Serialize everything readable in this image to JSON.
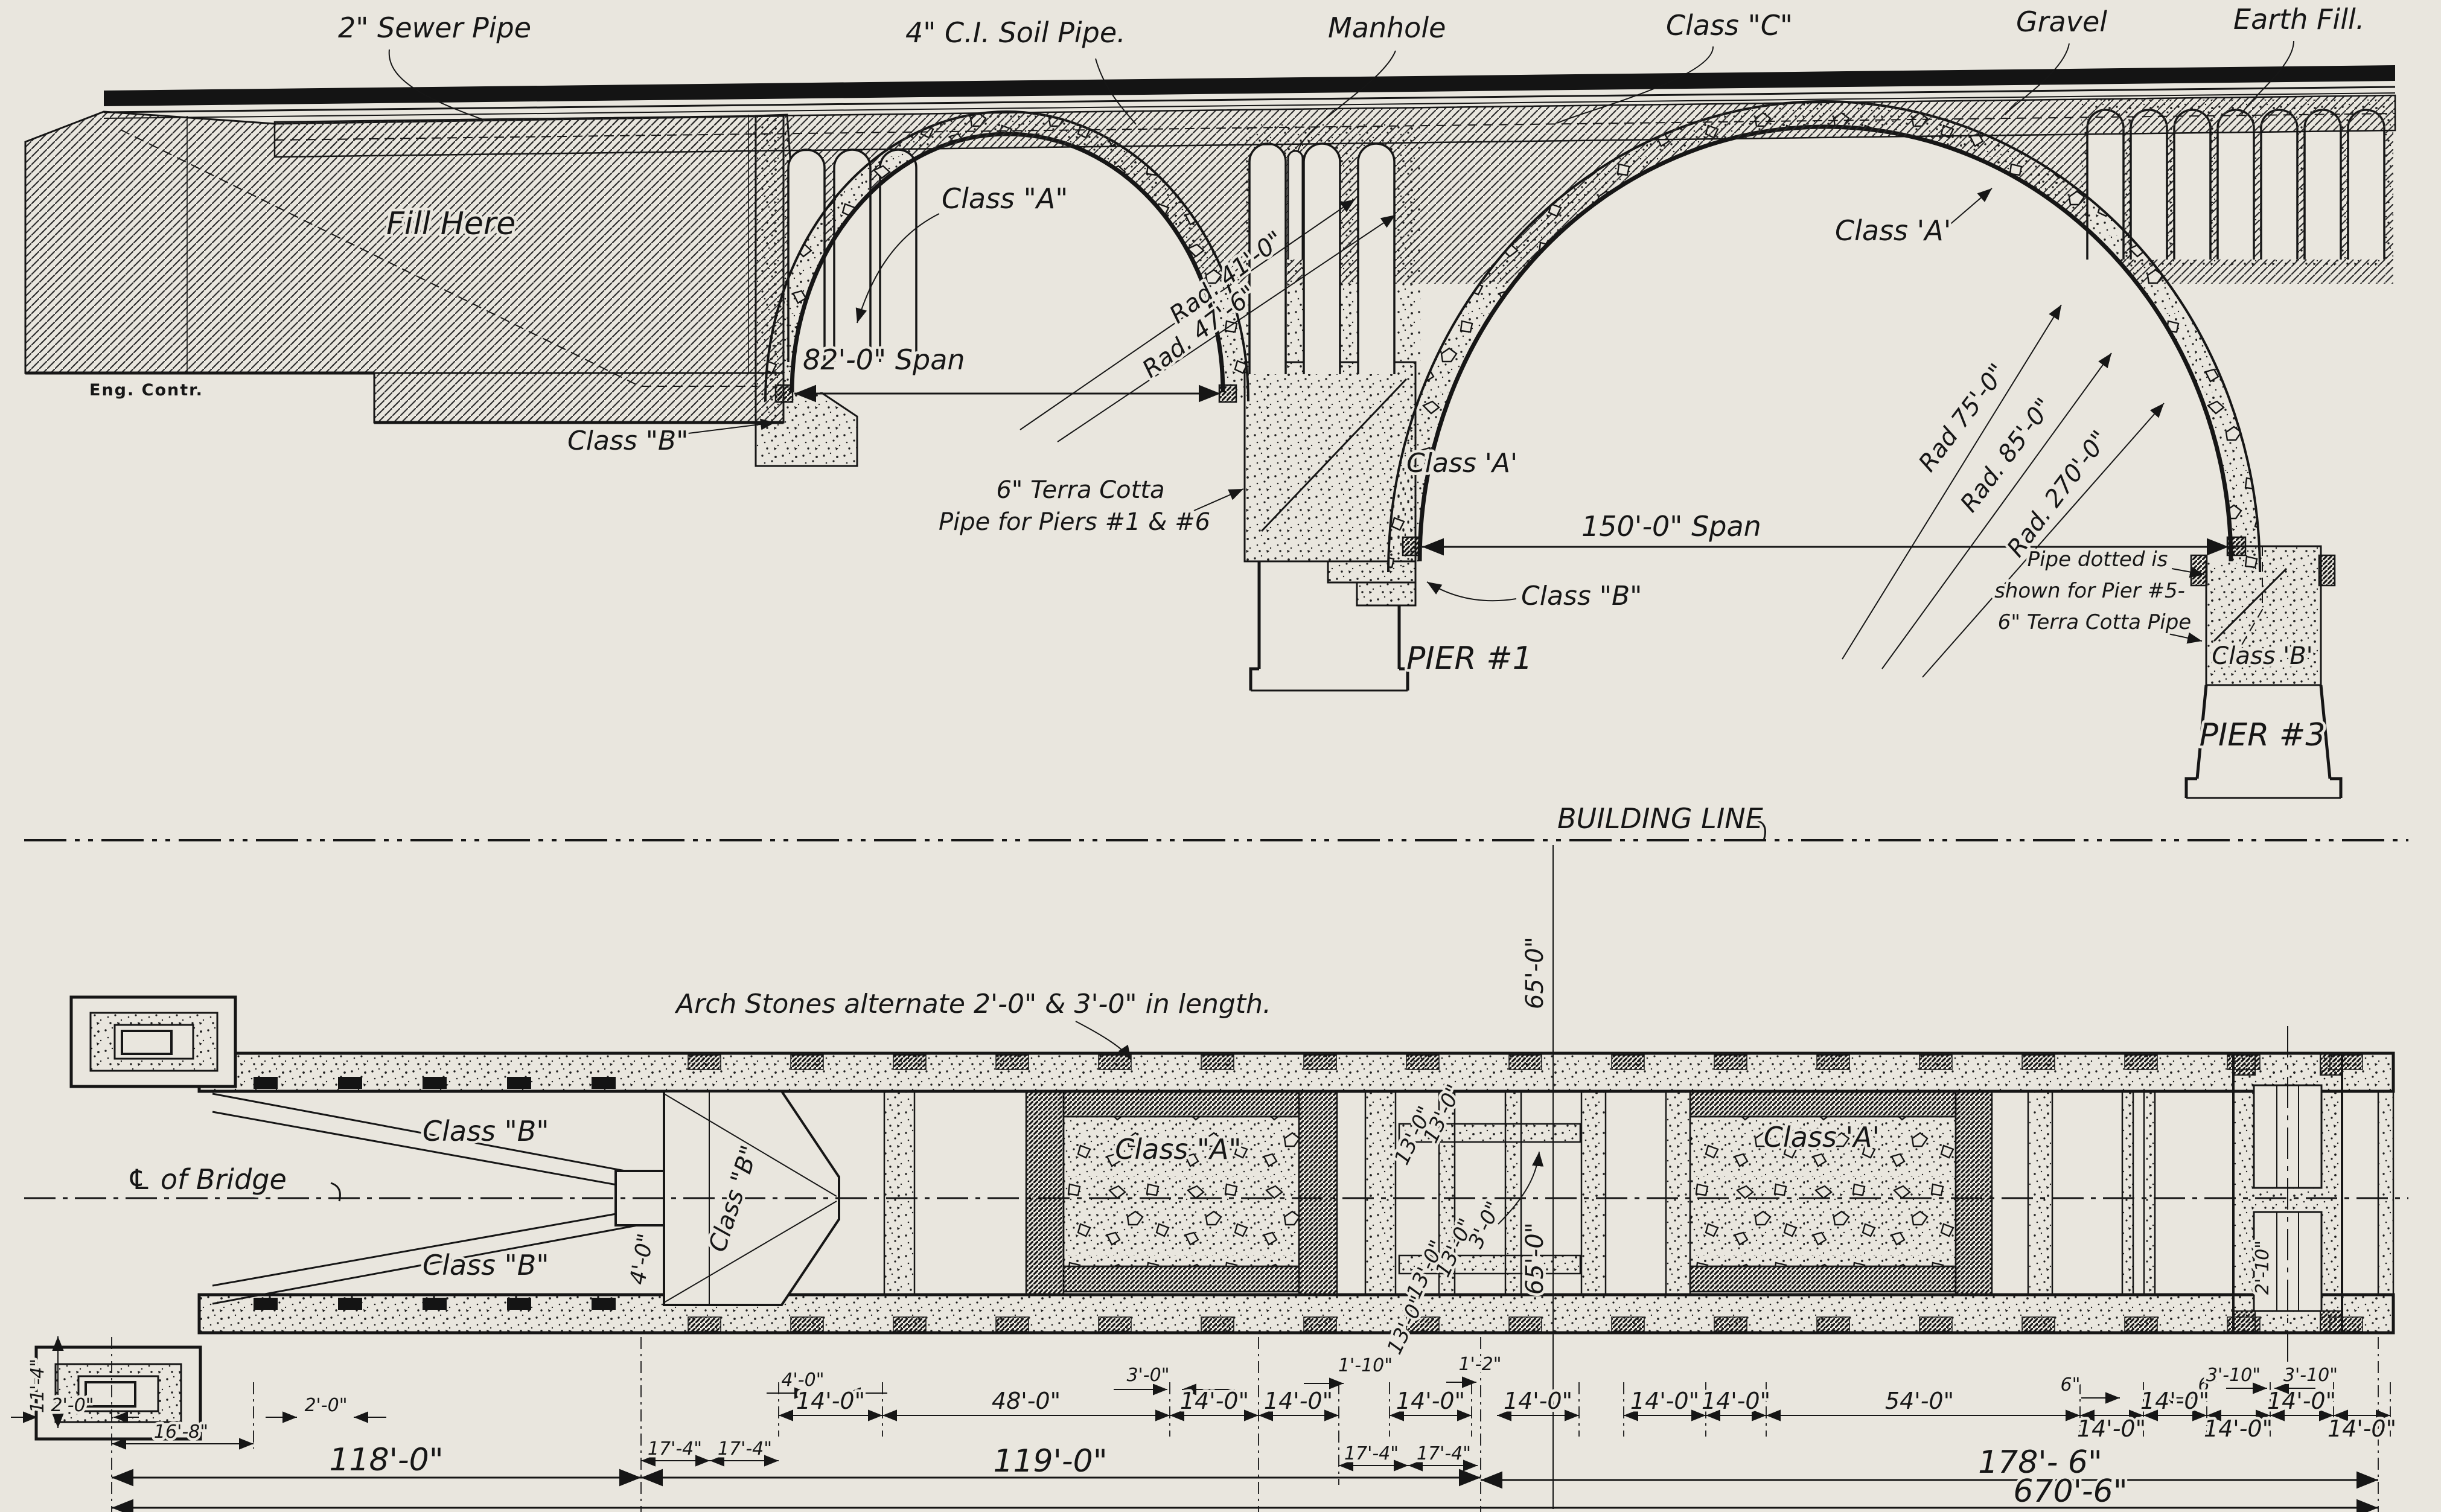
{
  "elevation": {
    "sewer_pipe": "2\" Sewer Pipe",
    "soil_pipe": "4\" C.I. Soil Pipe.",
    "manhole": "Manhole",
    "class_c": "Class \"C\"",
    "gravel": "Gravel",
    "earth_fill": "Earth Fill.",
    "fill_here": "Fill Here",
    "class_a_arch1": "Class \"A\"",
    "rad_41": "Rad. 41'-0\"",
    "rad_47": "Rad. 47'-6\"",
    "span_82": "82'-0\" Span",
    "class_b_abutment": "Class \"B\"",
    "terra_cotta_1": "6\" Terra Cotta",
    "terra_cotta_2": "Pipe for Piers #1 & #6",
    "class_a_pier1": "Class 'A'",
    "span_150": "150'-0\" Span",
    "class_b_pier1": "Class \"B\"",
    "pier_1": "PIER #1",
    "class_a_arch2": "Class 'A'",
    "rad_75": "Rad 75'-0\"",
    "rad_85": "Rad. 85'-0\"",
    "rad_270": "Rad. 270'-0\"",
    "pipe_dotted_1": "Pipe dotted is",
    "pipe_dotted_2": "shown for Pier #5-",
    "pipe_dotted_3": "6\" Terra Cotta Pipe",
    "class_b_pier3": "Class 'B'",
    "pier_3": "PIER #3",
    "eng_contr": "Eng. Contr."
  },
  "building_line_label": "BUILDING LINE",
  "plan": {
    "arch_stones": "Arch Stones alternate 2'-0\" & 3'-0\" in length.",
    "class_b_upper": "Class \"B\"",
    "class_b_lower": "Class \"B\"",
    "class_b_stem": "Class \"B\"",
    "class_a_mid": "Class \"A\"",
    "class_a_right": "Class 'A'",
    "cl_of_bridge": "℄ of Bridge",
    "dim_65_upper": "65'-0\"",
    "dim_65_lower": "65'-0\"",
    "dim_4_0": "4'-0\"",
    "dim_13_a": "13'-0\"",
    "dim_13_b": "13'-0\"",
    "dim_13_c": "13'-0\"",
    "dim_13_d": "13'-0\"",
    "dim_13_e": "13'-0\"",
    "dim_3_0": "3'-0\"",
    "dim_2_10": "2'-10\""
  },
  "dims": {
    "v11_4": "11'-4\"",
    "d2_0a": "2'-0\"",
    "d16_8": "16'-8\"",
    "d2_0b": "2'-0\"",
    "d118": "118'-0\"",
    "d4_0": "4'-0\"",
    "d17_4a": "17'-4\"",
    "d17_4b": "17'-4\"",
    "d14a": "14'-0\"",
    "d48": "48'-0\"",
    "d3_0": "3'-0\"",
    "d14b": "14'-0\"",
    "d119": "119'-0\"",
    "d14c": "14'-0\"",
    "d1_10": "1'-10\"",
    "d14d": "14'-0\"",
    "d1_2": "1'-2\"",
    "d14e": "14'-0\"",
    "d17_4c": "17'-4\"",
    "d17_4d": "17'-4\"",
    "d14f": "14'-0\"",
    "d14g": "14'-0\"",
    "d54": "54'-0\"",
    "d6a": "6\"",
    "d6b": "6\"",
    "d14h": "14'-0\"",
    "d14i": "14'-0\"",
    "d14j": "14'-0\"",
    "d3_10a": "3'-10\"",
    "d3_10b": "3'-10\"",
    "d14k": "14'-0\"",
    "d14l": "14'-0\"",
    "d178": "178'- 6\"",
    "d670": "670'-6\""
  }
}
